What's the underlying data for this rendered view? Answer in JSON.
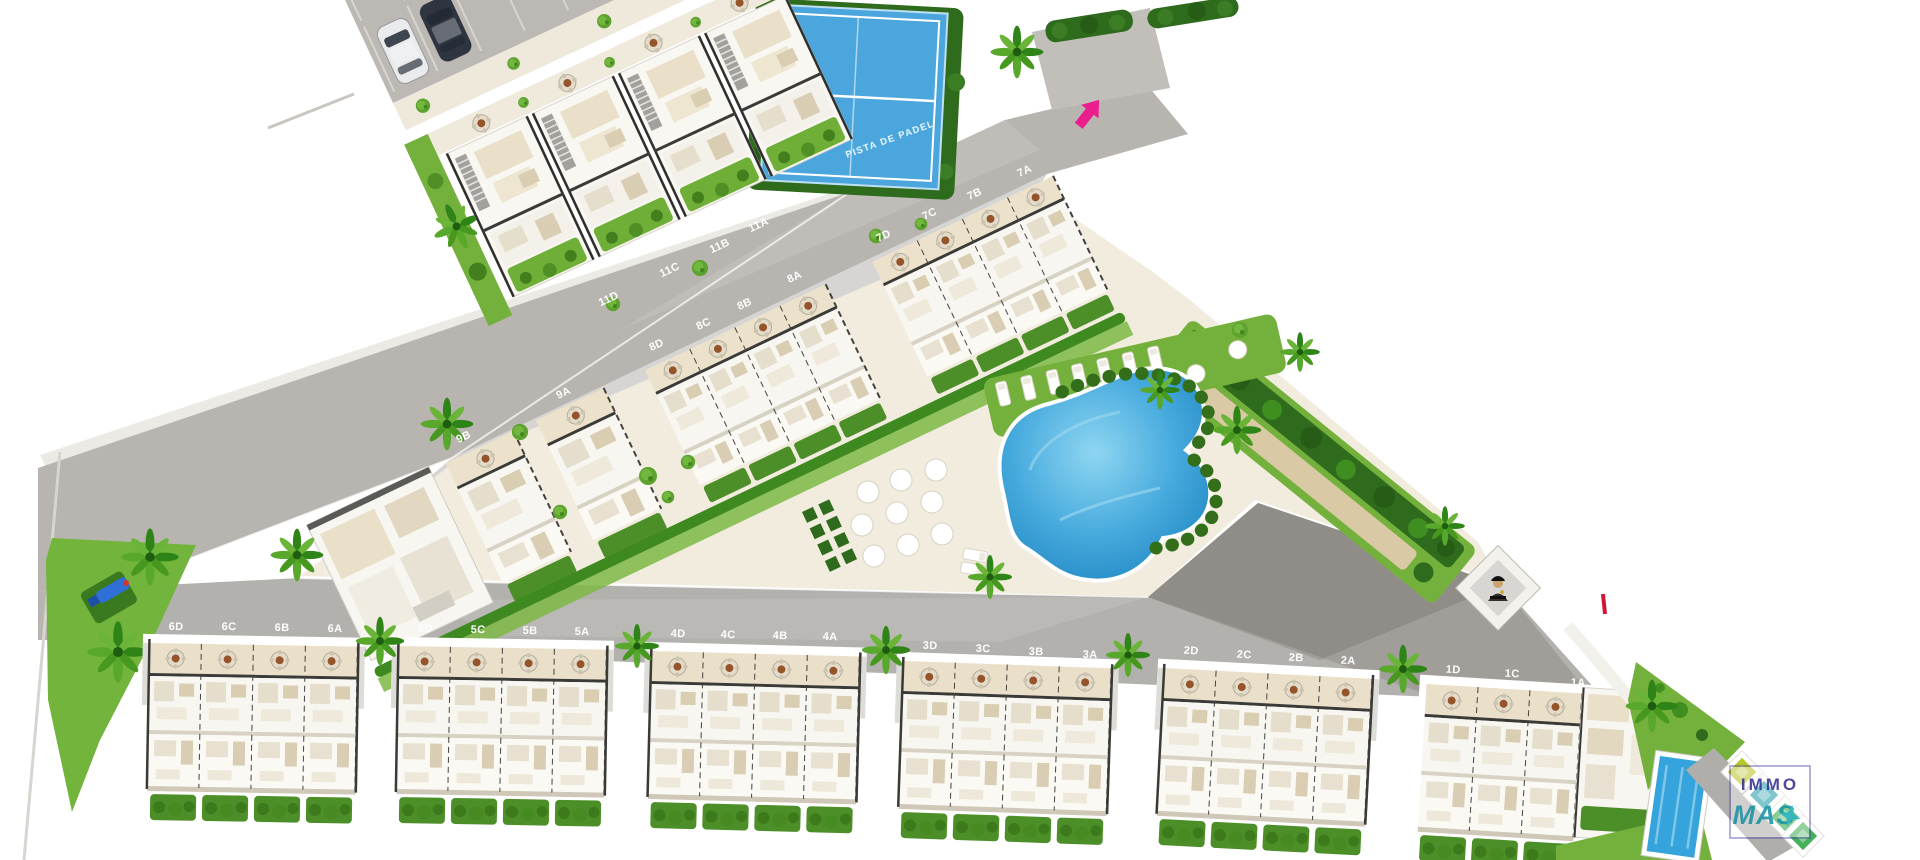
{
  "plan": {
    "title": "residential development site plan",
    "padel_label": "PISTA DE PADEL",
    "unit_labels": [
      {
        "text": "11A"
      },
      {
        "text": "11B"
      },
      {
        "text": "11C"
      },
      {
        "text": "11D"
      },
      {
        "text": "7A"
      },
      {
        "text": "7B"
      },
      {
        "text": "7C"
      },
      {
        "text": "7D"
      },
      {
        "text": "8A"
      },
      {
        "text": "8B"
      },
      {
        "text": "8C"
      },
      {
        "text": "8D"
      },
      {
        "text": "9A"
      },
      {
        "text": "9B"
      },
      {
        "text": "6D"
      },
      {
        "text": "6C"
      },
      {
        "text": "6B"
      },
      {
        "text": "6A"
      },
      {
        "text": "5D"
      },
      {
        "text": "5C"
      },
      {
        "text": "5B"
      },
      {
        "text": "5A"
      },
      {
        "text": "4D"
      },
      {
        "text": "4C"
      },
      {
        "text": "4B"
      },
      {
        "text": "4A"
      },
      {
        "text": "3D"
      },
      {
        "text": "3C"
      },
      {
        "text": "3B"
      },
      {
        "text": "3A"
      },
      {
        "text": "2D"
      },
      {
        "text": "2C"
      },
      {
        "text": "2B"
      },
      {
        "text": "2A"
      },
      {
        "text": "1D"
      },
      {
        "text": "1C"
      },
      {
        "text": "1A"
      }
    ],
    "colors": {
      "road": "#b8b5b1",
      "road_dark": "#908d89",
      "road_light": "#c6c3bf",
      "sidewalk": "#efe9dc",
      "deck": "#f2ecdf",
      "grass": "#72b43c",
      "hedge": "#2f6b1d",
      "hedge_row": "#4c8f28",
      "roof_white": "#f8f6f1",
      "terrace_cream": "#eadfc8",
      "pool_blue": "#47aadd",
      "padel_blue": "#4aa6dd",
      "entrance_arrow": "#ea1e8c",
      "marker_red": "#d01535"
    },
    "car_colors": [
      "#e9ebed",
      "#2e3440",
      "#9aa0a8",
      "#3a414d"
    ]
  },
  "logo": {
    "word1": "IMMO",
    "word2": "MAS",
    "word1_color": "#3d3a96",
    "word2_color": "#2499a8",
    "diamond_colors": [
      "#b9c428",
      "#2a9fae",
      "#35a84a",
      "#45b05a"
    ]
  }
}
